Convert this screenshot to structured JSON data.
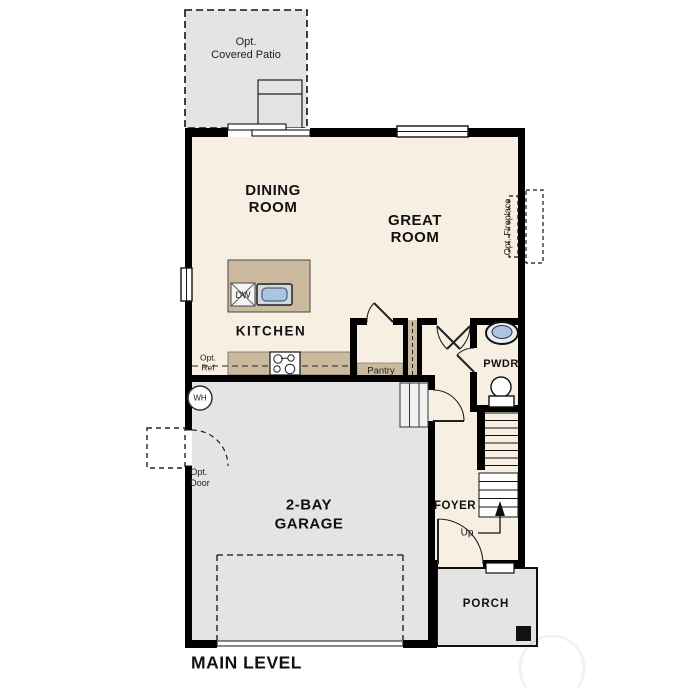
{
  "plan": {
    "title": "MAIN LEVEL",
    "rooms": {
      "patio": {
        "line1": "Opt.",
        "line2": "Covered Patio"
      },
      "dining": {
        "line1": "DINING",
        "line2": "ROOM"
      },
      "great": {
        "line1": "GREAT",
        "line2": "ROOM"
      },
      "kitchen": "KITCHEN",
      "pwdr": "PWDR",
      "garage": {
        "line1": "2-BAY",
        "line2": "GARAGE"
      },
      "foyer": "FOYER",
      "porch": "PORCH"
    },
    "annotations": {
      "opt_fireplace": "Opt. Fireplace",
      "opt_ref": {
        "line1": "Opt.",
        "line2": "Ref"
      },
      "opt_door": {
        "line1": "Opt.",
        "line2": "Door"
      },
      "pantry": "Pantry",
      "dishwasher": "DW",
      "water_heater": "WH",
      "stairs_up": "Up"
    },
    "colors": {
      "wall": "#000000",
      "interior_floor": "#f8efe3",
      "concrete": "#e4e4e4",
      "casework_tan": "#cbb99e",
      "fixture_blue": "#a9c5e1"
    }
  }
}
